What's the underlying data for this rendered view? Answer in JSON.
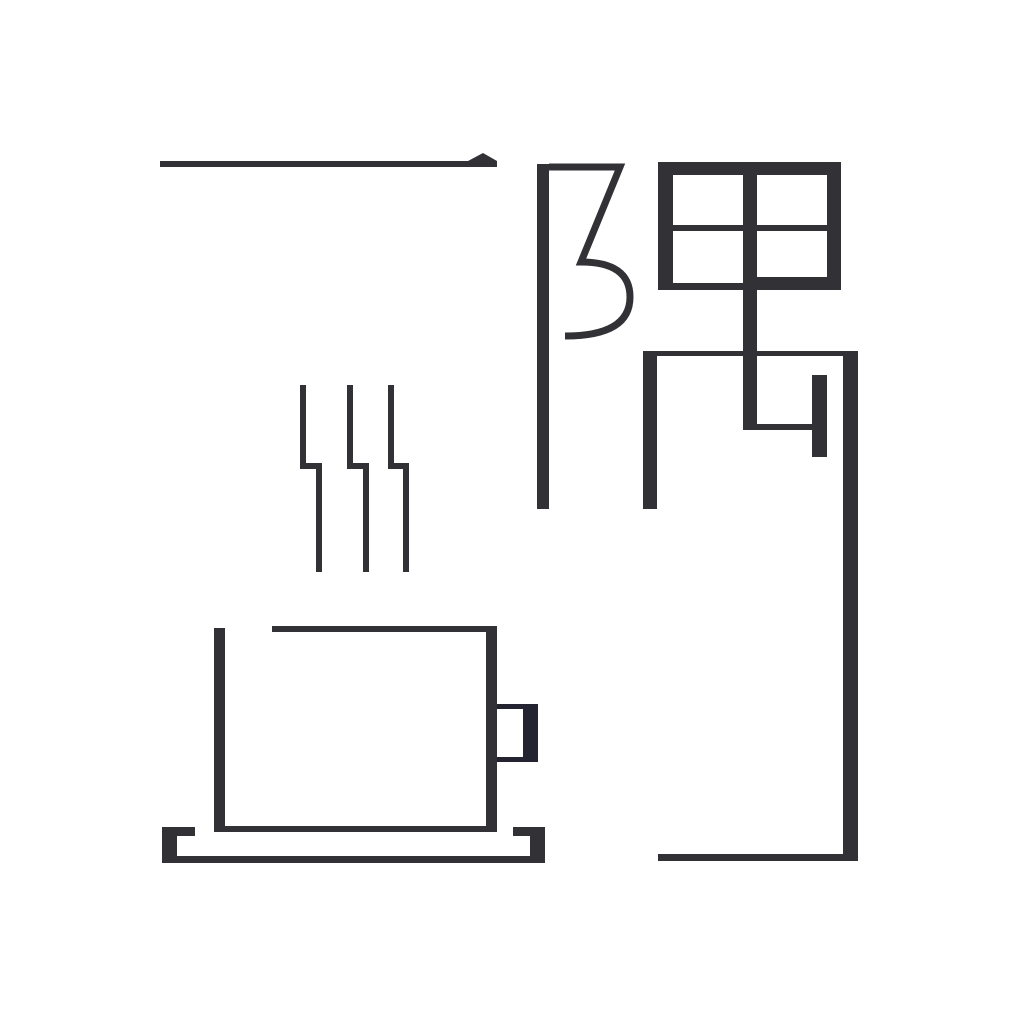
{
  "artwork": {
    "description": "Minimalist geometric logotype of the Chinese word for 'a corner' combined with a steaming coffee cup on a saucer",
    "word": "一隅",
    "characters": [
      "一",
      "隅"
    ],
    "background_color": "#ffffff",
    "ink_color": "#323135",
    "handle_color": "#232331",
    "canvas": {
      "width": 1024,
      "height": 1024
    }
  },
  "shapes": {
    "rects": [
      {
        "name": "yi-stroke-bar",
        "x": 160,
        "y": 161,
        "w": 337,
        "h": 6,
        "fill": "ink"
      },
      {
        "name": "fu-radical-stem",
        "x": 537,
        "y": 164,
        "w": 12,
        "h": 345,
        "fill": "ink"
      },
      {
        "name": "tian-top-border",
        "x": 658,
        "y": 162,
        "w": 183,
        "h": 13,
        "fill": "ink"
      },
      {
        "name": "tian-left-border",
        "x": 658,
        "y": 162,
        "w": 15,
        "h": 128,
        "fill": "ink"
      },
      {
        "name": "tian-right-border",
        "x": 827,
        "y": 162,
        "w": 14,
        "h": 128,
        "fill": "ink"
      },
      {
        "name": "tian-center-vertical",
        "x": 743,
        "y": 162,
        "w": 14,
        "h": 268,
        "fill": "ink"
      },
      {
        "name": "tian-center-horizontal",
        "x": 673,
        "y": 225,
        "w": 154,
        "h": 6,
        "fill": "ink"
      },
      {
        "name": "tian-bottom-border-left",
        "x": 673,
        "y": 283,
        "w": 70,
        "h": 7,
        "fill": "ink"
      },
      {
        "name": "tian-bottom-border-right",
        "x": 757,
        "y": 277,
        "w": 70,
        "h": 13,
        "fill": "ink"
      },
      {
        "name": "nei-top-bar",
        "x": 643,
        "y": 351,
        "w": 215,
        "h": 5,
        "fill": "ink"
      },
      {
        "name": "nei-left-leg",
        "x": 643,
        "y": 351,
        "w": 14,
        "h": 158,
        "fill": "ink"
      },
      {
        "name": "nei-right-leg",
        "x": 843,
        "y": 351,
        "w": 15,
        "h": 510,
        "fill": "ink"
      },
      {
        "name": "nei-bottom-bar",
        "x": 658,
        "y": 854,
        "w": 200,
        "h": 7,
        "fill": "ink"
      },
      {
        "name": "nei-hook-horizontal",
        "x": 743,
        "y": 424,
        "w": 69,
        "h": 6,
        "fill": "ink"
      },
      {
        "name": "nei-hook-bar",
        "x": 812,
        "y": 375,
        "w": 15,
        "h": 82,
        "fill": "ink"
      },
      {
        "name": "steam-line-1-upper",
        "x": 300,
        "y": 385,
        "w": 6,
        "h": 84,
        "fill": "ink"
      },
      {
        "name": "steam-line-1-jog",
        "x": 300,
        "y": 463,
        "w": 22,
        "h": 6,
        "fill": "ink"
      },
      {
        "name": "steam-line-1-lower",
        "x": 316,
        "y": 463,
        "w": 6,
        "h": 109,
        "fill": "ink"
      },
      {
        "name": "steam-line-2-upper",
        "x": 347,
        "y": 385,
        "w": 6,
        "h": 84,
        "fill": "ink"
      },
      {
        "name": "steam-line-2-jog",
        "x": 347,
        "y": 463,
        "w": 21,
        "h": 6,
        "fill": "ink"
      },
      {
        "name": "steam-line-2-lower",
        "x": 363,
        "y": 463,
        "w": 6,
        "h": 109,
        "fill": "ink"
      },
      {
        "name": "steam-line-3-upper",
        "x": 388,
        "y": 385,
        "w": 6,
        "h": 84,
        "fill": "ink"
      },
      {
        "name": "steam-line-3-jog",
        "x": 388,
        "y": 463,
        "w": 21,
        "h": 6,
        "fill": "ink"
      },
      {
        "name": "steam-line-3-lower",
        "x": 403,
        "y": 463,
        "w": 6,
        "h": 109,
        "fill": "ink"
      },
      {
        "name": "cup-left-wall",
        "x": 214,
        "y": 628,
        "w": 11,
        "h": 204,
        "fill": "ink"
      },
      {
        "name": "cup-rim",
        "x": 272,
        "y": 626,
        "w": 225,
        "h": 6,
        "fill": "ink"
      },
      {
        "name": "cup-right-wall",
        "x": 486,
        "y": 626,
        "w": 11,
        "h": 206,
        "fill": "ink"
      },
      {
        "name": "cup-base-line",
        "x": 225,
        "y": 826,
        "w": 261,
        "h": 6,
        "fill": "ink"
      },
      {
        "name": "cup-handle-top-bar",
        "x": 497,
        "y": 704,
        "w": 41,
        "h": 5,
        "fill": "handle"
      },
      {
        "name": "cup-handle-right-bar",
        "x": 523,
        "y": 704,
        "w": 15,
        "h": 58,
        "fill": "handle"
      },
      {
        "name": "cup-handle-bottom-bar",
        "x": 497,
        "y": 757,
        "w": 41,
        "h": 5,
        "fill": "handle"
      },
      {
        "name": "saucer-left-cap",
        "x": 162,
        "y": 827,
        "w": 15,
        "h": 36,
        "fill": "ink"
      },
      {
        "name": "saucer-rim-left",
        "x": 162,
        "y": 827,
        "w": 33,
        "h": 9,
        "fill": "ink"
      },
      {
        "name": "saucer-rim-right",
        "x": 513,
        "y": 827,
        "w": 32,
        "h": 9,
        "fill": "ink"
      },
      {
        "name": "saucer-right-cap",
        "x": 530,
        "y": 827,
        "w": 15,
        "h": 36,
        "fill": "ink"
      },
      {
        "name": "saucer-base",
        "x": 162,
        "y": 856,
        "w": 383,
        "h": 7,
        "fill": "ink"
      }
    ],
    "polygons": [
      {
        "name": "yi-stroke-tip",
        "points": "468,161 483,153 497,161",
        "fill": "ink"
      }
    ],
    "paths": [
      {
        "name": "fu-radical-curl",
        "d": "M 549 167 L 620 167 L 581 262 Q 630 262 630 297 Q 630 336 565 336",
        "stroke": "ink",
        "width": 7
      }
    ]
  }
}
